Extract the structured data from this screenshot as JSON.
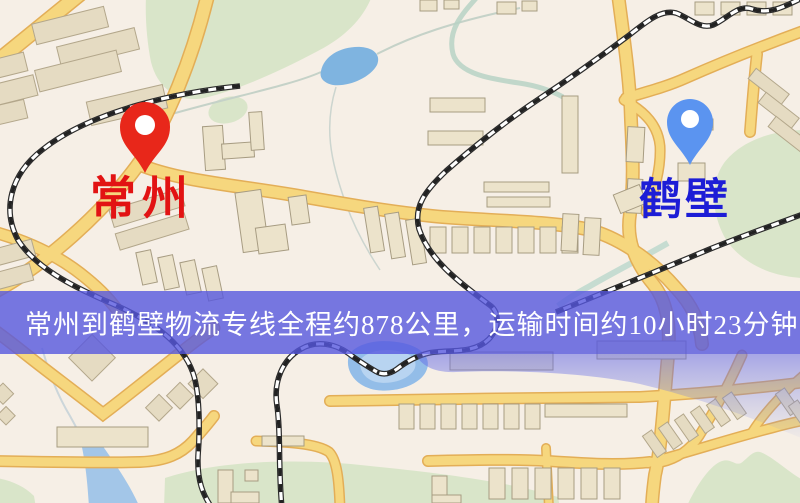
{
  "banner": {
    "text": "常州到鹤壁物流专线全程约878公里，运输时间约10小时23分钟.",
    "background_color": "#5658de",
    "text_color": "#ffffff"
  },
  "markers": {
    "origin": {
      "label": "常州",
      "pin_color": "#e8271a",
      "label_color": "#e21313"
    },
    "destination": {
      "label": "鹤壁",
      "pin_color": "#5b94f0",
      "label_color": "#1d1dd6"
    }
  },
  "route": {
    "origin": "常州",
    "destination": "鹤壁",
    "distance": "约878公里",
    "duration": "约10小时23分钟"
  },
  "map": {
    "colors": {
      "background": "#f6efe6",
      "road_fill": "#f6d77e",
      "road_border": "#e3ae57",
      "park": "#d9e5c9",
      "water": "#7fb4e0",
      "building": "#ece3cb",
      "railway": "#2b2b2b"
    }
  }
}
